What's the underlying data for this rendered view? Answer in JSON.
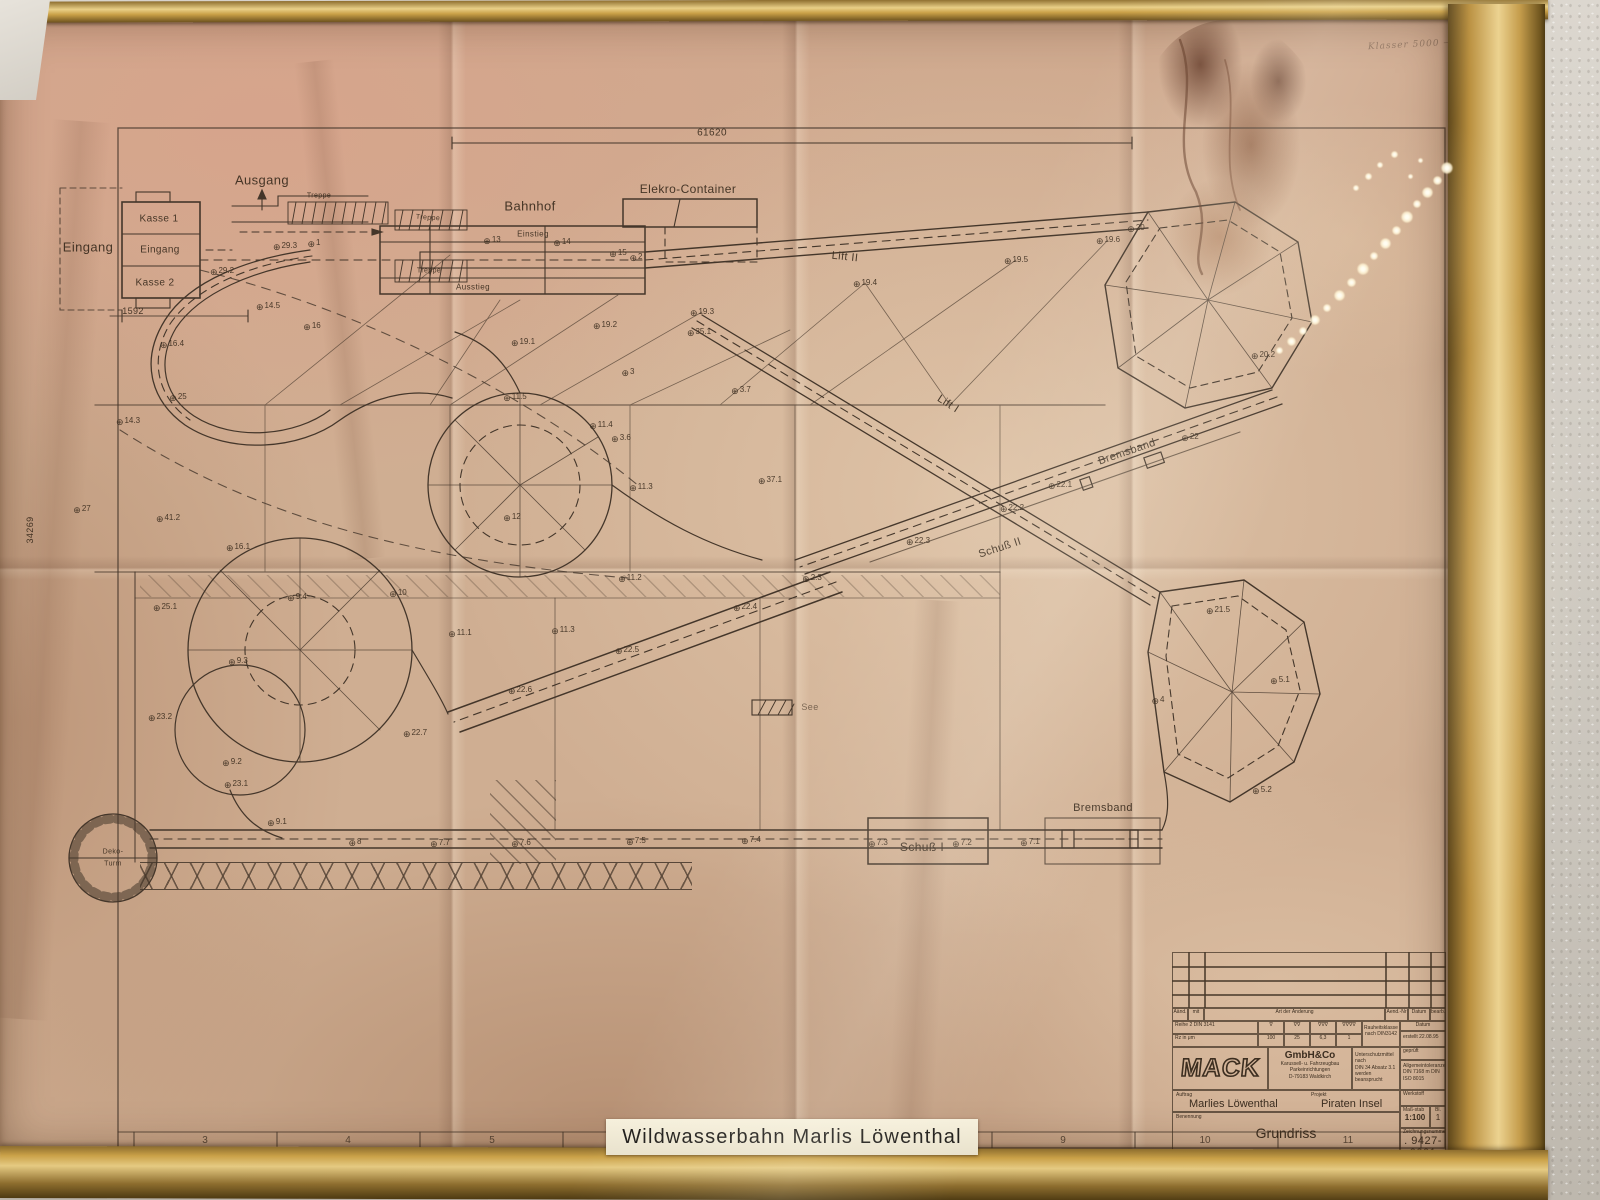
{
  "plate": {
    "text": "Wildwasserbahn  Marlis  Löwenthal"
  },
  "handwriting": "Klasser 5000 —",
  "drawing": {
    "dims": {
      "top_width": "61620",
      "left_height": "34269",
      "entrance": "1592"
    },
    "labels": {
      "eingang_outer": "Eingang",
      "kasse1": "Kasse 1",
      "eingang_inner": "Eingang",
      "kasse2": "Kasse 2",
      "ausgang": "Ausgang",
      "treppe": "Treppe",
      "bahnhof": "Bahnhof",
      "einstieg": "Einstieg",
      "ausstieg": "Ausstieg",
      "elekro_container": "Elekro-Container",
      "lift2": "Lift II",
      "lift1": "Lift I",
      "bremsband": "Bremsband",
      "schuss2": "Schuß II",
      "schuss1": "Schuß I",
      "see": "See",
      "deko_line1": "Deko-",
      "deko_line2": "Turm"
    },
    "track_points": [
      {
        "x": 285,
        "y": 246,
        "t": "29.3"
      },
      {
        "x": 314,
        "y": 243,
        "t": "1"
      },
      {
        "x": 222,
        "y": 271,
        "t": "29.2"
      },
      {
        "x": 268,
        "y": 306,
        "t": "14.5"
      },
      {
        "x": 172,
        "y": 344,
        "t": "16.4"
      },
      {
        "x": 312,
        "y": 326,
        "t": "16"
      },
      {
        "x": 178,
        "y": 397,
        "t": "25"
      },
      {
        "x": 128,
        "y": 421,
        "t": "14.3"
      },
      {
        "x": 82,
        "y": 509,
        "t": "27"
      },
      {
        "x": 168,
        "y": 518,
        "t": "41.2"
      },
      {
        "x": 238,
        "y": 547,
        "t": "16.1"
      },
      {
        "x": 165,
        "y": 607,
        "t": "25.1"
      },
      {
        "x": 297,
        "y": 597,
        "t": "9.4"
      },
      {
        "x": 398,
        "y": 593,
        "t": "10"
      },
      {
        "x": 238,
        "y": 661,
        "t": "9.3"
      },
      {
        "x": 160,
        "y": 717,
        "t": "23.2"
      },
      {
        "x": 232,
        "y": 762,
        "t": "9.2"
      },
      {
        "x": 236,
        "y": 784,
        "t": "23.1"
      },
      {
        "x": 277,
        "y": 822,
        "t": "9.1"
      },
      {
        "x": 355,
        "y": 842,
        "t": "8"
      },
      {
        "x": 440,
        "y": 843,
        "t": "7.7"
      },
      {
        "x": 521,
        "y": 843,
        "t": "7.6"
      },
      {
        "x": 636,
        "y": 841,
        "t": "7.5"
      },
      {
        "x": 751,
        "y": 840,
        "t": "7.4"
      },
      {
        "x": 878,
        "y": 843,
        "t": "7.3"
      },
      {
        "x": 962,
        "y": 843,
        "t": "7.2"
      },
      {
        "x": 1030,
        "y": 842,
        "t": "7.1"
      },
      {
        "x": 415,
        "y": 733,
        "t": "22.7"
      },
      {
        "x": 460,
        "y": 633,
        "t": "11.1"
      },
      {
        "x": 520,
        "y": 690,
        "t": "22.6"
      },
      {
        "x": 563,
        "y": 630,
        "t": "11.3"
      },
      {
        "x": 627,
        "y": 650,
        "t": "22.5"
      },
      {
        "x": 745,
        "y": 607,
        "t": "22.4"
      },
      {
        "x": 812,
        "y": 578,
        "t": "2.3"
      },
      {
        "x": 630,
        "y": 578,
        "t": "11.2"
      },
      {
        "x": 512,
        "y": 517,
        "t": "12"
      },
      {
        "x": 605,
        "y": 325,
        "t": "19.2"
      },
      {
        "x": 702,
        "y": 312,
        "t": "19.3"
      },
      {
        "x": 699,
        "y": 332,
        "t": "35.1"
      },
      {
        "x": 523,
        "y": 342,
        "t": "19.1"
      },
      {
        "x": 628,
        "y": 372,
        "t": "3"
      },
      {
        "x": 741,
        "y": 390,
        "t": "3.7"
      },
      {
        "x": 515,
        "y": 397,
        "t": "11.5"
      },
      {
        "x": 601,
        "y": 425,
        "t": "11.4"
      },
      {
        "x": 621,
        "y": 438,
        "t": "3.6"
      },
      {
        "x": 641,
        "y": 487,
        "t": "11.3"
      },
      {
        "x": 770,
        "y": 480,
        "t": "37.1"
      },
      {
        "x": 865,
        "y": 283,
        "t": "19.4"
      },
      {
        "x": 1016,
        "y": 260,
        "t": "19.5"
      },
      {
        "x": 1108,
        "y": 240,
        "t": "19.6"
      },
      {
        "x": 1136,
        "y": 228,
        "t": "20"
      },
      {
        "x": 1263,
        "y": 355,
        "t": "20.2"
      },
      {
        "x": 1190,
        "y": 437,
        "t": "22"
      },
      {
        "x": 1060,
        "y": 485,
        "t": "22.1"
      },
      {
        "x": 1012,
        "y": 508,
        "t": "22.2"
      },
      {
        "x": 918,
        "y": 541,
        "t": "22.3"
      },
      {
        "x": 618,
        "y": 253,
        "t": "15"
      },
      {
        "x": 636,
        "y": 257,
        "t": "2"
      },
      {
        "x": 492,
        "y": 240,
        "t": "13"
      },
      {
        "x": 562,
        "y": 242,
        "t": "14"
      },
      {
        "x": 1158,
        "y": 700,
        "t": "4"
      },
      {
        "x": 1280,
        "y": 680,
        "t": "5.1"
      },
      {
        "x": 1262,
        "y": 790,
        "t": "5.2"
      },
      {
        "x": 1218,
        "y": 610,
        "t": "21.5"
      }
    ],
    "grid_numbers": [
      {
        "x": 205,
        "t": "3"
      },
      {
        "x": 348,
        "t": "4"
      },
      {
        "x": 492,
        "t": "5"
      },
      {
        "x": 1063,
        "t": "9"
      },
      {
        "x": 1205,
        "t": "10"
      },
      {
        "x": 1348,
        "t": "11"
      }
    ]
  },
  "title_block": {
    "rev": {
      "aend": "Aänd.",
      "mit": "mit",
      "art": "Art der Änderung",
      "aend_nr": "Aend.-Nr",
      "datum": "Datum",
      "bearb": "bearb."
    },
    "surface": {
      "reihe": "Reihe 2 DIN 3141",
      "rz": "Rz in μm",
      "v1": "∇",
      "v2": "∇∇",
      "v3": "∇∇∇",
      "v4": "∇∇∇∇",
      "r1": "100",
      "r2": "25",
      "r3": "6,3",
      "r4": "1",
      "rauheit1": "Rauheitsklasse",
      "rauheit2": "nach DIN3142"
    },
    "mack": {
      "logo": "MACK",
      "gmbh": "GmbH&Co",
      "line1": "Karussell- u. Fahrzeugbau",
      "line2": "Parkeinrichtungen",
      "line3": "D-79183 Waldkirch"
    },
    "mitte": {
      "l1": "Unterschutzmittel nach",
      "l2": "DIN 34 Absatz 3.1",
      "l3": "werden beansprucht"
    },
    "right": {
      "datum": "Datum",
      "erstellt": "erstellt",
      "erstellt_datum": "22.08.95",
      "geprueft": "geprüft",
      "allg1": "Allgemeintoleranzen",
      "allg2": "DIN 7168 m  DIN ISO 8015",
      "werkstoff": "Werkstoff"
    },
    "order": {
      "auftrag_label": "Auftrag",
      "auftrag": "Marlies Löwenthal",
      "projekt_label": "Projekt",
      "projekt": "Piraten Insel"
    },
    "name": {
      "benennung_label": "Benennung",
      "benennung": "Grundriss"
    },
    "numbers": {
      "massstab_label": "Maß-stab",
      "massstab": "1:100",
      "blatt_label": "Bl.",
      "blatt": "1",
      "znr_label": "Zeichnungsnummer",
      "znr": ". 9427-0001",
      "cad_label": "CAD-Dateiname",
      "cad": "94270001.DWG"
    }
  }
}
